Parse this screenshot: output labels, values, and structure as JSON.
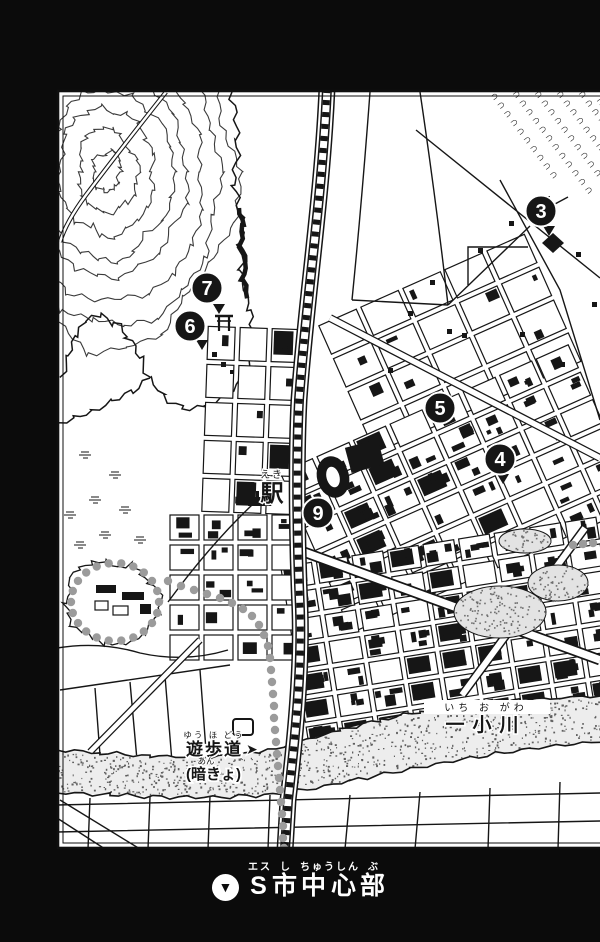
{
  "caption": {
    "icon": "▼",
    "title": "S市中心部",
    "furigana": "エス し ちゅうしん ぶ",
    "segments": [
      {
        "base": "S",
        "ruby": "エス"
      },
      {
        "base": "市",
        "ruby": "し"
      },
      {
        "base": "中心",
        "ruby": "ちゅうしん"
      },
      {
        "base": "部",
        "ruby": "ぶ"
      }
    ]
  },
  "labels": {
    "station": {
      "text": "駅",
      "furigana": "えき"
    },
    "river": {
      "text": "一小川",
      "furigana": "いち お がわ"
    },
    "promenade": {
      "text": "遊歩道",
      "furigana": "ゆう ほ どう",
      "arrow": "➤"
    },
    "culvert": {
      "text": "(暗きょ)",
      "furigana": "あん"
    }
  },
  "markers": [
    {
      "number": "3",
      "x": 541,
      "y": 211,
      "pointer": {
        "x": 549,
        "y": 226
      }
    },
    {
      "number": "4",
      "x": 500,
      "y": 459,
      "pointer": {
        "x": 503,
        "y": 474
      }
    },
    {
      "number": "5",
      "x": 440,
      "y": 408,
      "pointer": null
    },
    {
      "number": "6",
      "x": 190,
      "y": 326,
      "pointer": {
        "x": 202,
        "y": 340
      }
    },
    {
      "number": "7",
      "x": 207,
      "y": 288,
      "pointer": {
        "x": 219,
        "y": 304
      }
    },
    {
      "number": "9",
      "x": 318,
      "y": 513,
      "pointer": null
    }
  ],
  "colors": {
    "ink": "#161616",
    "paper": "#ffffff",
    "path_dots": "#9b9b9b",
    "river_stipple": "#5f5f5f",
    "surround": "#0b0b0b"
  }
}
